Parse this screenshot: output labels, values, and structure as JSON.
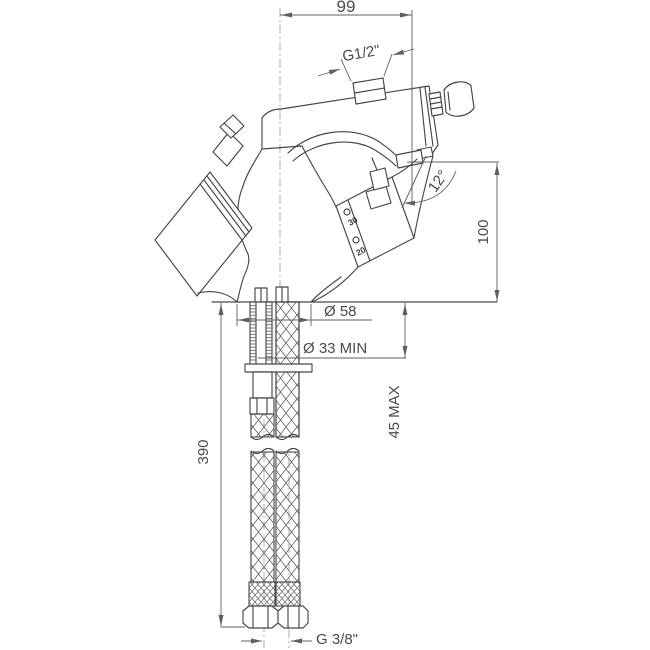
{
  "drawing": {
    "labels": {
      "spout_reach": "99",
      "inlet_thread_top": "G1/2\"",
      "spout_angle": "12°",
      "outlet_height": "100",
      "base_diameter": "Ø 58",
      "min_hole_diameter": "Ø 33 MIN",
      "max_deck_thickness": "45 MAX",
      "supply_hose_length": "390",
      "supply_hose_thread": "G 3/8\"",
      "handle_scale_upper": "30",
      "handle_scale_lower": "20"
    },
    "colors": {
      "line": "#474747",
      "dimension_line": "#5f5f5f",
      "centerline": "#9a9a9a",
      "text": "#4a4a4a",
      "background": "#ffffff"
    }
  }
}
